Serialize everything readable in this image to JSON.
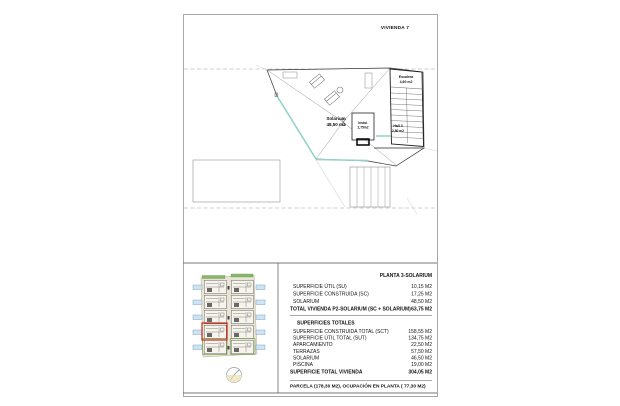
{
  "page": {
    "title": "VIVIENDA 7"
  },
  "plan": {
    "solarium_label": "Solarium",
    "solarium_area": "48,50 m2",
    "escalera_label": "Escalera",
    "escalera_area": "4,60 m2",
    "instal_label": "Instal.",
    "instal_area": "2,75m2",
    "hall_label": "Hall 3",
    "hall_area": "2,80 m2"
  },
  "tables": {
    "planta": {
      "header": "PLANTA 3-SOLARIUM",
      "rows": [
        {
          "label": "SUPERFICIE ÚTIL (SU)",
          "value": "10,15 M2"
        },
        {
          "label": "SUPERFICIE CONSTRUIDA (SC)",
          "value": "17,25 M2"
        },
        {
          "label": "SOLARIUM",
          "value": "48,50 M2"
        }
      ],
      "total": {
        "label": "TOTAL VIVIENDA P2-SOLARIUM (SC + SOLARIUM)",
        "value": "63,75 M2"
      }
    },
    "totales": {
      "header": "SUPERFICIES TOTALES",
      "rows": [
        {
          "label": "SUPERFICIE CONSTRUIDA TOTAL (SCT)",
          "value": "158,55 M2"
        },
        {
          "label": "SUPERFICIE ÚTIL TOTAL (SUT)",
          "value": "134,75 M2"
        },
        {
          "label": "APARCAMIENTO",
          "value": "22,50 M2"
        },
        {
          "label": "TERRAZAS",
          "value": "57,50 M2"
        },
        {
          "label": "SOLARIUM",
          "value": "46,50 M2"
        },
        {
          "label": "PISCINA",
          "value": "19,00 M2"
        }
      ],
      "total": {
        "label": "SUPERFICIE TOTAL VIVIENDA",
        "value": "304,05 M2"
      }
    },
    "parcela": "PARCELA  (178,30 M2), OCUPACIÓN EN PLANTA ( 77,30 M2)"
  },
  "colors": {
    "accent_teal": "#93d2cb",
    "highlight_red": "#cc2a1e",
    "pool_blue": "#cfe3f2",
    "site_beige": "#e9e4d5",
    "hedge_green": "#86b868"
  }
}
